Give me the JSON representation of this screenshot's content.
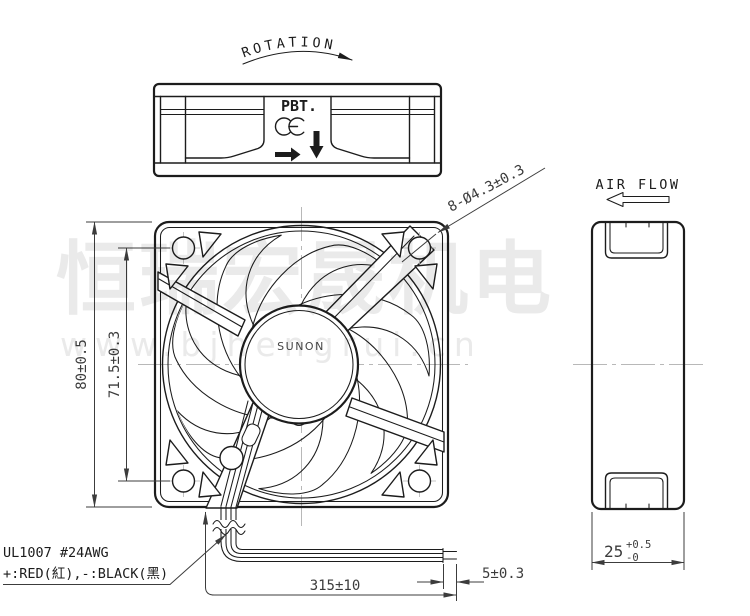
{
  "top_view": {
    "rotation_label": "ROTATION",
    "material_label": "PBT.",
    "ce_mark_label": "CE"
  },
  "front_view": {
    "hub_brand": "SUNON",
    "mounting_holes_label": "8-Ø4.3±0.3",
    "height_dim": "80±0.5",
    "hole_pitch_dim": "71.5±0.3"
  },
  "side_view": {
    "airflow_label": "AIR FLOW",
    "depth_value": "25",
    "depth_tol_plus": "+0.5",
    "depth_tol_minus": "-0"
  },
  "leads": {
    "spec_line1": "UL1007  #24AWG",
    "spec_line2": "+:RED(紅),-:BLACK(黑)",
    "length_dim": "315±10",
    "strip_dim": "5±0.3"
  },
  "watermark": {
    "line1": "恒瑞宏晟机电",
    "line2": "www.bjhengrui.cn"
  },
  "colors": {
    "line": "#1c1c1c",
    "dim": "#3c3c3c",
    "centerline": "#b8b8b8",
    "watermark": "#eaeaea",
    "background": "#ffffff"
  }
}
